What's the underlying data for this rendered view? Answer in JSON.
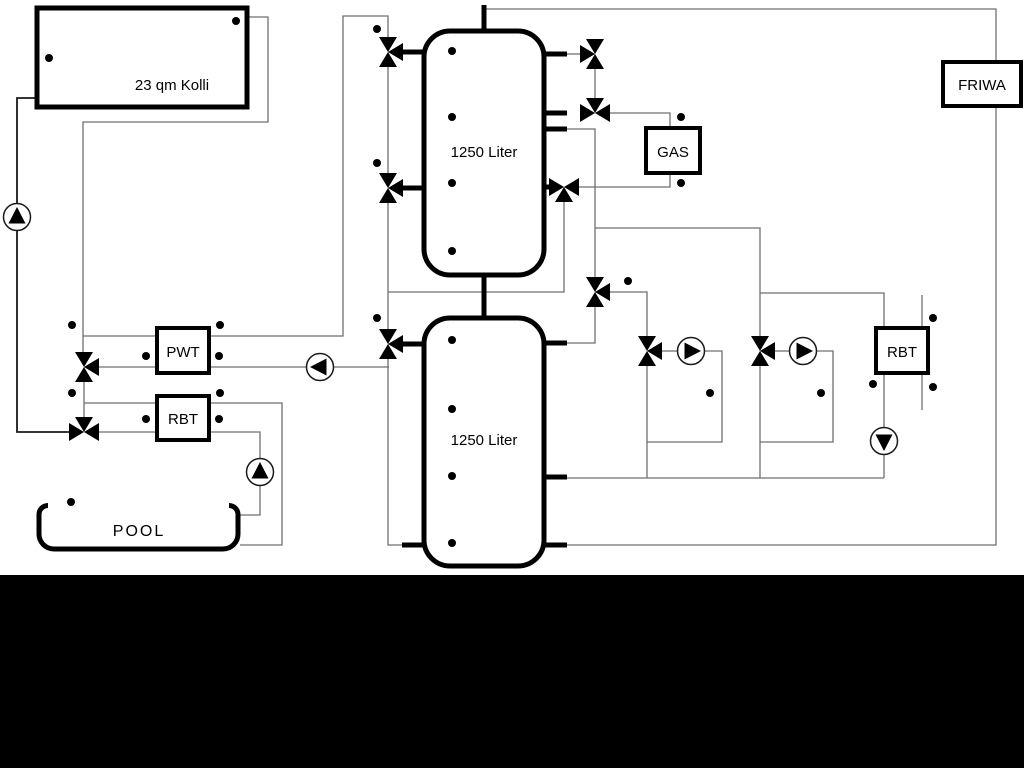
{
  "labels": {
    "collector": "23 qm Kolli",
    "tank_top": "1250 Liter",
    "tank_bottom": "1250 Liter",
    "pwt": "PWT",
    "rbt_left": "RBT",
    "gas": "GAS",
    "friwa": "FRIWA",
    "rbt_right": "RBT",
    "pool": "POOL"
  },
  "symbols": {
    "pump_icon": "circle with solid flow-direction triangle",
    "three_way_valve_icon": "three open triangles meeting at a point",
    "temperature_sensor_icon": "small circle with short stem",
    "pump_count": 6,
    "three_way_valve_count": 11,
    "temperature_sensor_count": 30
  },
  "colors": {
    "background": "#ffffff",
    "pipe_thin": "#6f6f6f",
    "pipe_thick": "#000000",
    "bottom_bar": "#000000"
  }
}
